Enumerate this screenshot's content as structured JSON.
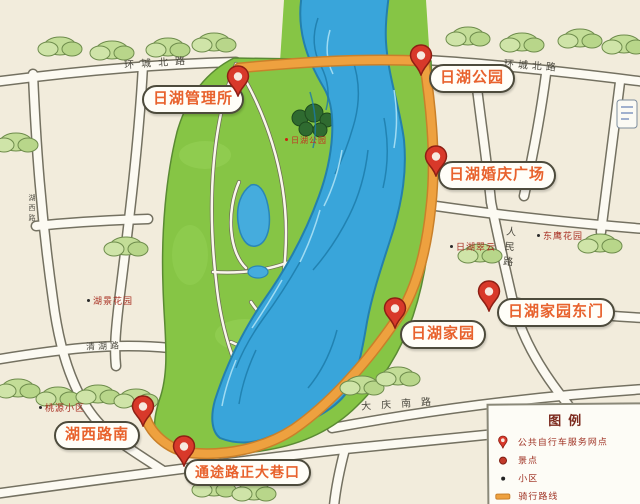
{
  "stations": [
    {
      "label": "日湖管理所"
    },
    {
      "label": "日湖公园"
    },
    {
      "label": "日湖婚庆广场"
    },
    {
      "label": "日湖家园"
    },
    {
      "label": "日湖家园东门"
    },
    {
      "label": "湖西路南"
    },
    {
      "label": "通途路正大巷口"
    }
  ],
  "roads": [
    {
      "label": "环城北路"
    },
    {
      "label": "环城北路"
    },
    {
      "label": "清湖路"
    },
    {
      "label": "大庆南路"
    },
    {
      "label": "人民路"
    },
    {
      "label": "湖西路"
    }
  ],
  "places": [
    {
      "label": "湖景花园",
      "category": "小区"
    },
    {
      "label": "桃源小区",
      "category": "小区"
    },
    {
      "label": "日湖翠云",
      "category": "小区"
    },
    {
      "label": "东鹰花园",
      "category": "小区"
    },
    {
      "label": "日湖公园",
      "category": "景点"
    }
  ],
  "legend": {
    "title": "图例",
    "items": [
      {
        "icon": "bike-station-pin",
        "label": "公共自行车服务网点"
      },
      {
        "icon": "scenic-spot-dot",
        "label": "景点"
      },
      {
        "icon": "residential-dot",
        "label": "小区"
      },
      {
        "icon": "cycling-route-line",
        "label": "骑行路线"
      }
    ]
  },
  "colors": {
    "route": "#eea13f",
    "river": "#39a5da",
    "park": "#86c545",
    "pin": "#d8392a",
    "station_text": "#e8622d",
    "background": "#f2ecdc"
  }
}
